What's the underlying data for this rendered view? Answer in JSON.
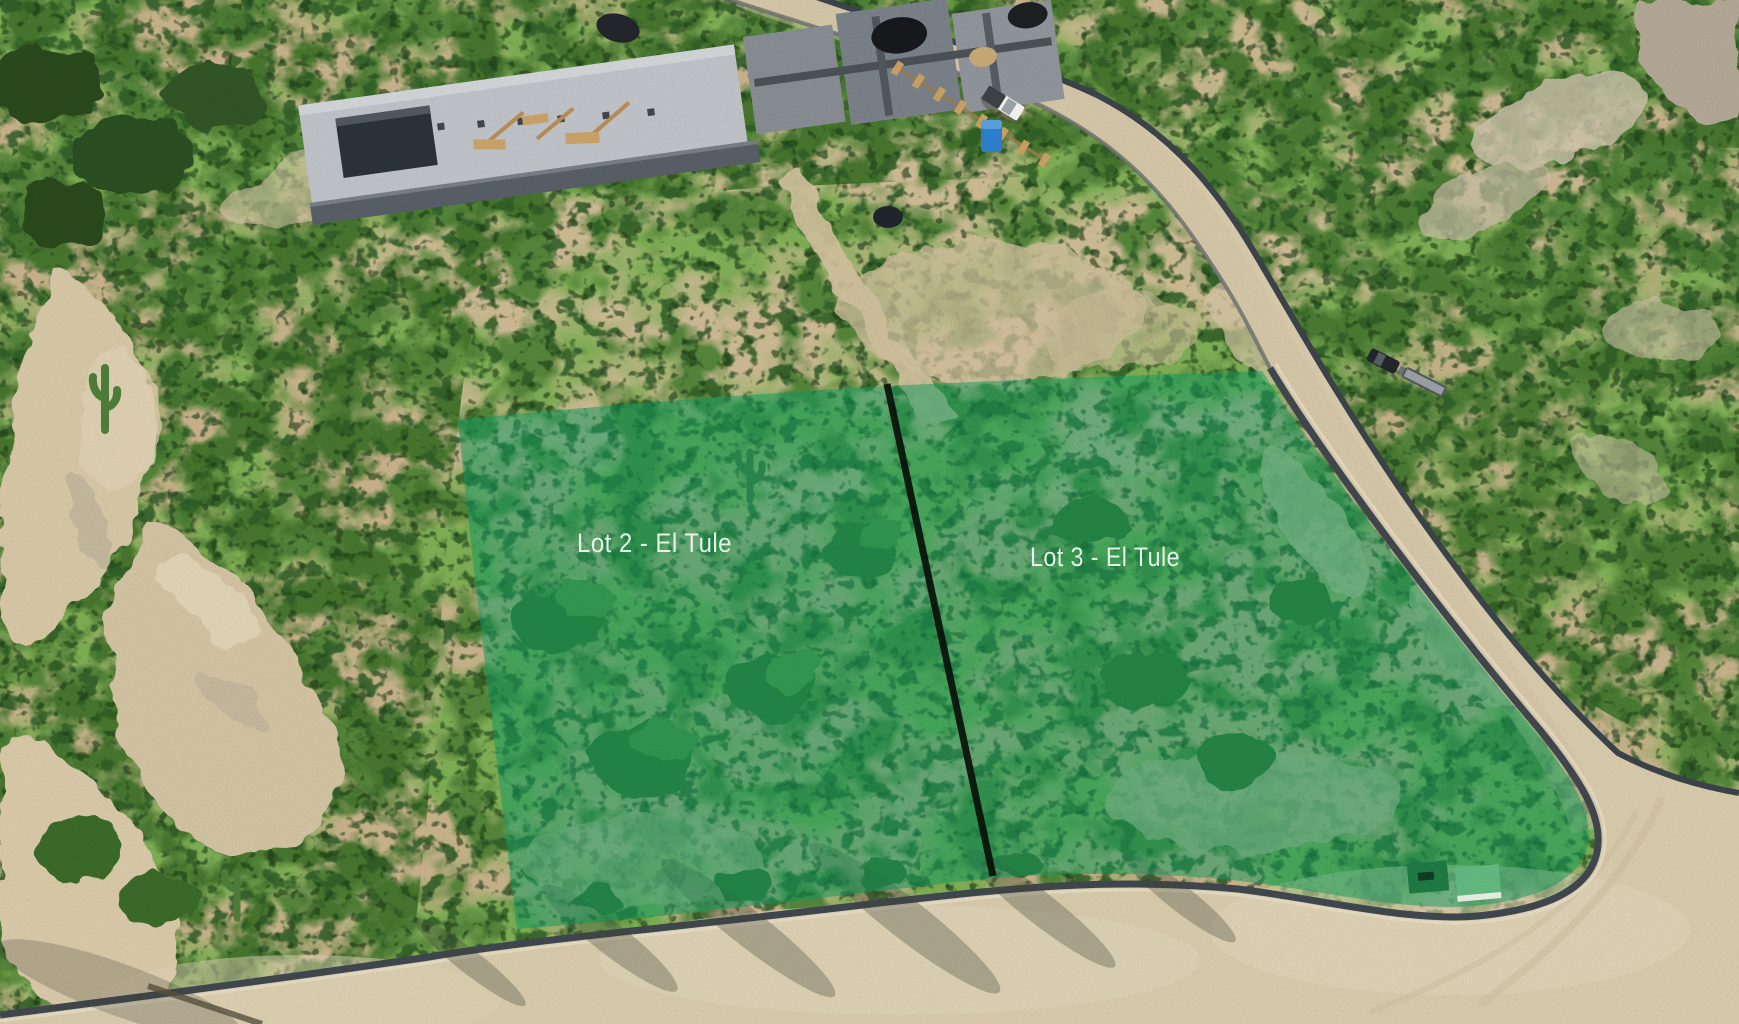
{
  "lots": [
    {
      "id": "lot-2",
      "label": "Lot 2 - El Tule"
    },
    {
      "id": "lot-3",
      "label": "Lot 3 - El Tule"
    }
  ],
  "colors": {
    "overlay_green": "#0f9b60",
    "divider_line": "#0a120b",
    "label_text": "#f2fcf2"
  }
}
